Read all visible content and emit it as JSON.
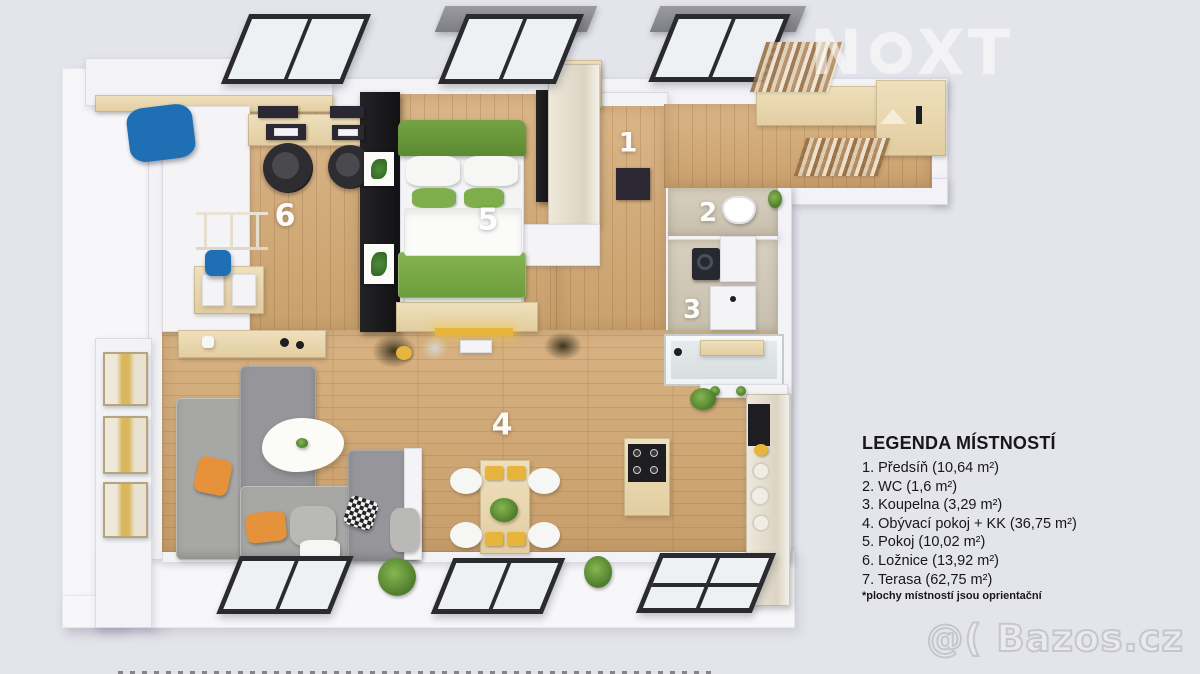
{
  "colors": {
    "background": "#e4e4eb",
    "wall": "#f3f3f7",
    "wall_edge": "#dadae2",
    "terrace": "#f7f7fa",
    "window_frame": "#2b2b2f",
    "glass": "#eef1f4",
    "pillow_orange": "#e6923a",
    "pillow_blue": "#1f6fb5",
    "accent_yellow": "#e7b43c"
  },
  "watermarks": {
    "brand_pre": "N",
    "brand_post": "XT",
    "site": "@( Bazos.cz"
  },
  "plan_labels": [
    {
      "text": "1",
      "room": "predsin"
    },
    {
      "text": "2",
      "room": "wc"
    },
    {
      "text": "3",
      "room": "koupelna"
    },
    {
      "text": "4",
      "room": "obyvaci-pokoj"
    },
    {
      "text": "5",
      "room": "pokoj"
    },
    {
      "text": "6",
      "room": "loznice"
    }
  ],
  "legend": {
    "title": "LEGENDA MÍSTNOSTÍ",
    "items": [
      {
        "text": "1. Předsíň  (10,64 m²)"
      },
      {
        "text": "2. WC (1,6 m²)"
      },
      {
        "text": "3. Koupelna (3,29 m²)"
      },
      {
        "text": "4. Obývací pokoj  + KK (36,75 m²)"
      },
      {
        "text": "5. Pokoj (10,02 m²)"
      },
      {
        "text": "6. Ložnice (13,92 m²)"
      },
      {
        "text": "7. Terasa (62,75 m²)"
      }
    ],
    "footnote": "*plochy místností jsou oprientační"
  }
}
